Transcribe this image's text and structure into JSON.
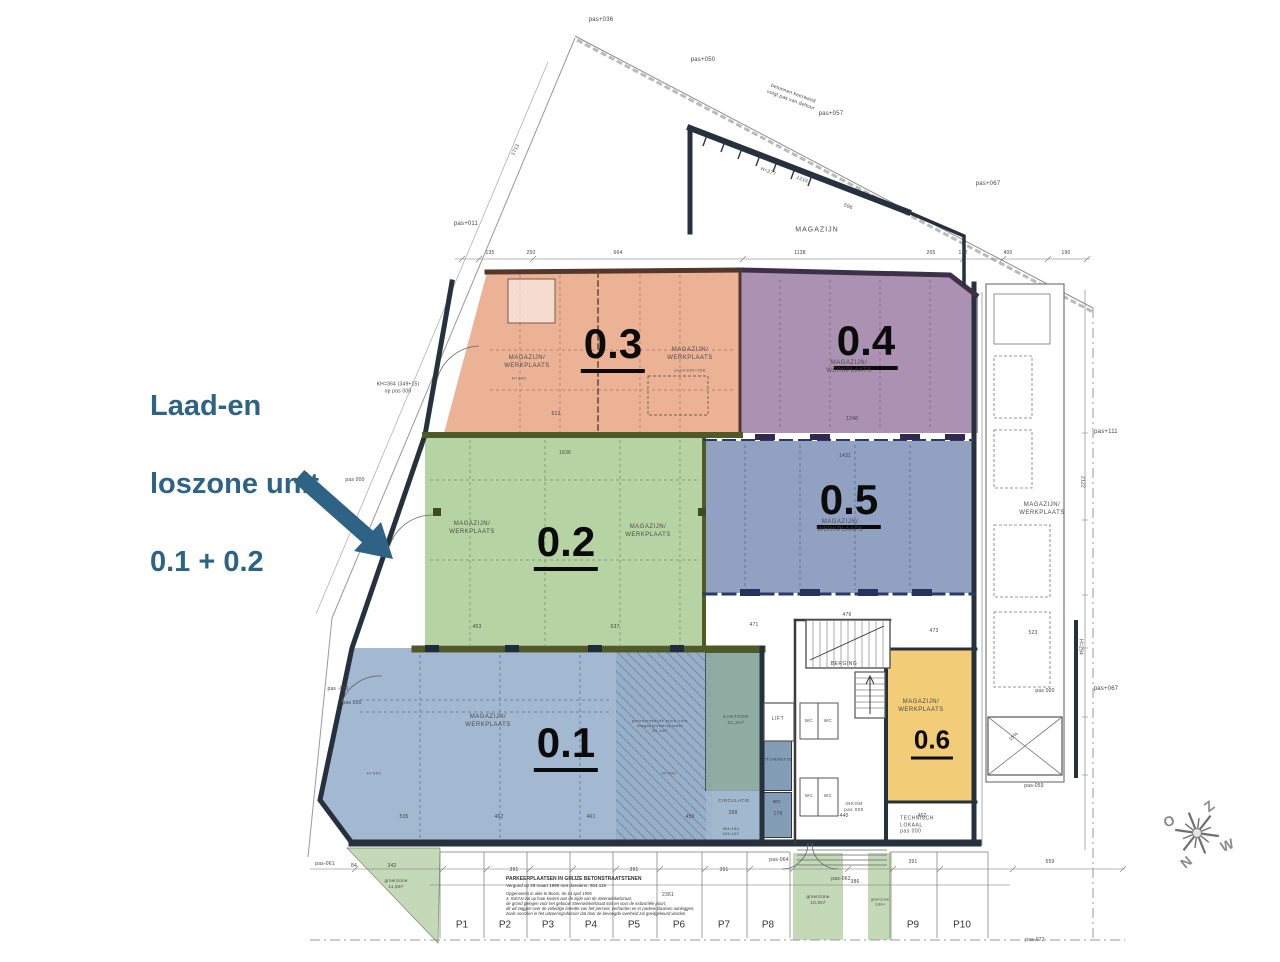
{
  "annotation": {
    "lines": [
      "Laad-en",
      "loszone unit",
      "0.1 + 0.2"
    ],
    "color": "#2E6386"
  },
  "zones": {
    "z01": "0.1",
    "z02": "0.2",
    "z03": "0.3",
    "z04": "0.4",
    "z05": "0.5",
    "z06": "0.6"
  },
  "zone_colors": {
    "z01": "#9AB0C9",
    "z02": "#AFD09E",
    "z03": "#ECA98E",
    "z04": "#9F80A8",
    "z05": "#8296BA",
    "z06": "#F0CB70"
  },
  "rooms": {
    "mw": "MAGAZIJN/\nWERKPLAATS",
    "magazijn": "MAGAZIJN",
    "h300": "H=300",
    "plafond": "plafondH=298",
    "balk": "balkH=265",
    "kantoor": "KANTOOR\n21,3m²",
    "circulatie": "CIRCULATIE",
    "lift": "LIFT",
    "wc": "WC",
    "kitchenette": "KITCHENETTE",
    "berging": "BERGING",
    "inkom": "INKOM\npas 000",
    "technisch": "TECHNISCH\nLOKAAL\npas 000",
    "reserved": "gereserveerde zone voor\nmagazijn/werkplaats\n46,1m²"
  },
  "site": {
    "keerwand": "betonnen keerwand\nvolgt pas van deltour",
    "kh364": "KH=364 (349+15)\nop pas 000",
    "pas036": "pas+036",
    "pas050": "pas+050",
    "pas057": "pas+057",
    "pas067": "pas+067",
    "pas011": "pas+011",
    "pas111": "pas+111",
    "pas000": "pas 000",
    "pasm030": "pas -030",
    "pasm059": "pas-059",
    "pasm061": "pas-061",
    "pasm062": "pas-062",
    "pasm064": "pas-064",
    "pasm072": "pas-072"
  },
  "dims": {
    "d1713": "1713",
    "d135": "135",
    "d250": "250",
    "d664": "664",
    "d1138": "1138",
    "d265": "265",
    "d132": "132",
    "d400": "400",
    "d190": "190",
    "d1215": "1215",
    "dh277": "H=277",
    "d596": "596",
    "d612": "612",
    "d1248": "1248",
    "d1636": "1636",
    "d1431": "1431",
    "d453": "453",
    "d637": "637",
    "d476": "476",
    "d471": "471",
    "d473": "473",
    "d523": "523",
    "d535": "535",
    "d462": "462",
    "d461": "461",
    "d459": "459",
    "d440": "440",
    "d179": "179",
    "d288": "288",
    "dbh": "BH=154\nDH=122",
    "d391": "391",
    "d386": "386",
    "d559": "559",
    "d2361": "2361",
    "d342": "342",
    "d84": "84",
    "d2122": "2122",
    "dh294": "H=294",
    "d15": "15%"
  },
  "parking": {
    "stalls": [
      "P1",
      "P2",
      "P3",
      "P4",
      "P5",
      "P6",
      "P7",
      "P8",
      "P9",
      "P10"
    ],
    "note_title": "PARKEERPLAATSEN IN GRIJZE BETONSTRAATSTENEN",
    "note_sub": "Vergund op 28 maart 1995 met dossiernr. 504.115",
    "note_body": "Opgenomen in akte te Boom, de 14 april 1995\n4. IGEAN zal op haar kosten aan de zijde van de Steenwinkelstraat,\nde grond gelegen voor het gebouw Steenwinkelstraat 644 en voor de industriële poort,\ndit wil zeggen over de volledige breedte van het perceel, verharden en er parkeerplaatsen aanleggen,\nzoals voorzien in het uitvoeringsdossier dat door de bevoegde overheid zal goedgekeurd worden."
  },
  "groen": {
    "g118": "groenzone\n11,8m²",
    "g103": "groenzone\n10,3m²",
    "g38": "groenzone\n3,8m²"
  },
  "compass": {
    "z": "Z",
    "o": "O",
    "w": "W",
    "n": "N"
  }
}
